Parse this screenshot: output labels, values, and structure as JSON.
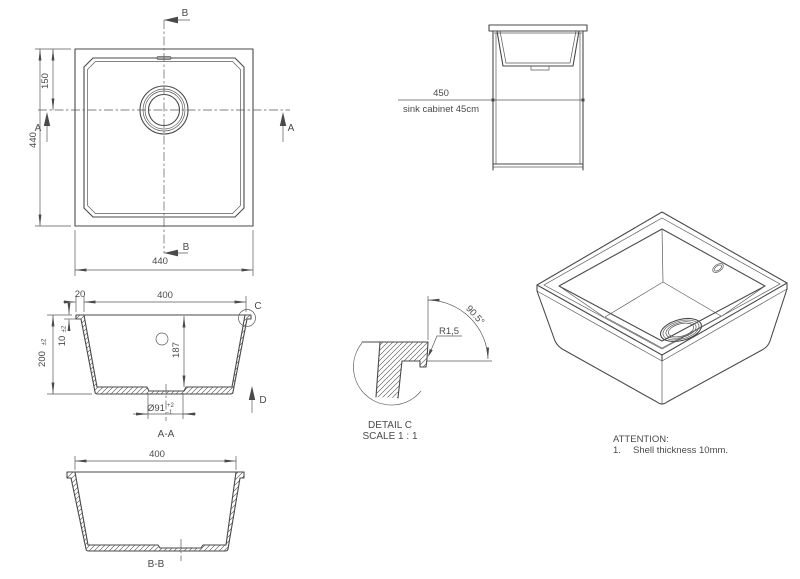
{
  "labels": {
    "top_view": {
      "width": "440",
      "height": "440",
      "drain_offset": "150",
      "section_a": "A",
      "section_b": "B"
    },
    "cabinet": {
      "width": "450",
      "caption": "sink cabinet 45cm"
    },
    "section_aa": {
      "name": "A-A",
      "opening_width": "400",
      "rim_offset": "20",
      "height": "200",
      "height_tol": "±2",
      "shell": "10",
      "shell_tol": "±2",
      "depth": "187",
      "drain": "Ø91",
      "drain_tol_plus": "+2",
      "drain_tol_minus": "-1",
      "detail": "C",
      "direction": "D"
    },
    "section_bb": {
      "name": "B-B",
      "opening_width": "400"
    },
    "detail_c": {
      "radius": "R1,5",
      "angle": "90.5°",
      "title": "DETAIL C",
      "scale": "SCALE 1 : 1"
    },
    "notes": {
      "heading": "ATTENTION:",
      "item_no": "1.",
      "item_text": "Shell thickness 10mm."
    }
  },
  "colors": {
    "line": "#4a4a4a",
    "background": "#ffffff"
  }
}
